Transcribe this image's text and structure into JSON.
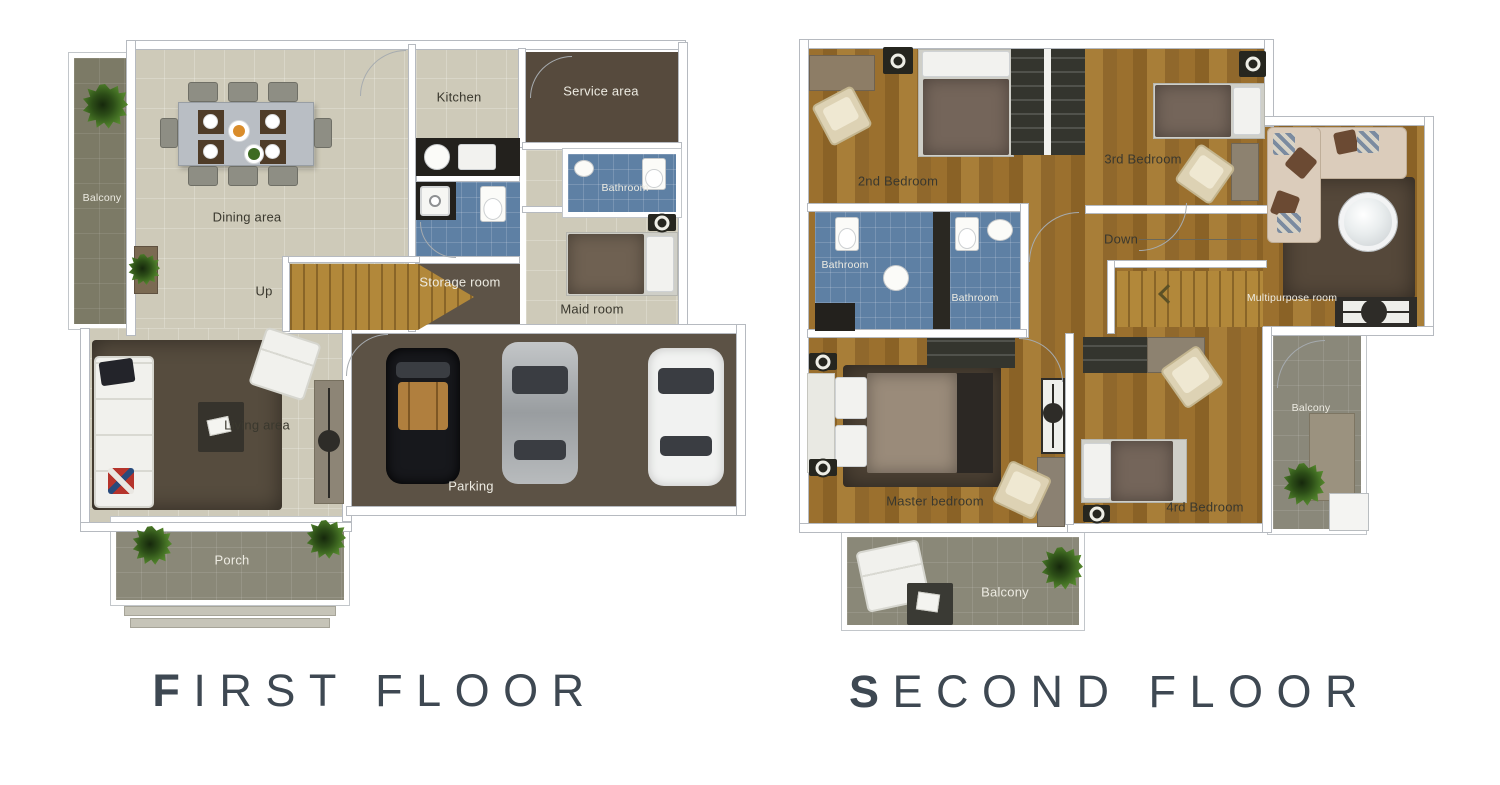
{
  "first_floor": {
    "title": "FIRST FLOOR",
    "labels": {
      "balcony": "Balcony",
      "dining_area": "Dining area",
      "kitchen": "Kitchen",
      "service_area": "Service area",
      "bathroom": "Bathroom",
      "storage_room": "Storage room",
      "maid_room": "Maid room",
      "up": "Up",
      "living_area": "Living area",
      "parking": "Parking",
      "porch": "Porch"
    }
  },
  "second_floor": {
    "title": "SECOND FLOOR",
    "labels": {
      "bedroom_2nd": "2nd Bedroom",
      "bedroom_3rd": "3rd Bedroom",
      "bathroom_left": "Bathroom",
      "bathroom_right": "Bathroom",
      "down": "Down",
      "multipurpose_room": "Multipurpose room",
      "master_bedroom": "Master bedroom",
      "bedroom_4th": "4rd Bedroom",
      "balcony_side": "Balcony",
      "balcony_rear": "Balcony"
    }
  },
  "colors": {
    "floor_light": "#cecab9",
    "wood_floor": "#9b702e",
    "stairs_wood": "#b2883a",
    "balcony_olive": "#7c7a66",
    "porch_olive": "#8a8878",
    "parking_brown": "#5c5245",
    "service_brown": "#564a3d",
    "storage_brown": "#5d5347",
    "bathroom_blue": "#5e80a4",
    "rug_brown": "#564c3e",
    "title_text": "#3e4852"
  }
}
